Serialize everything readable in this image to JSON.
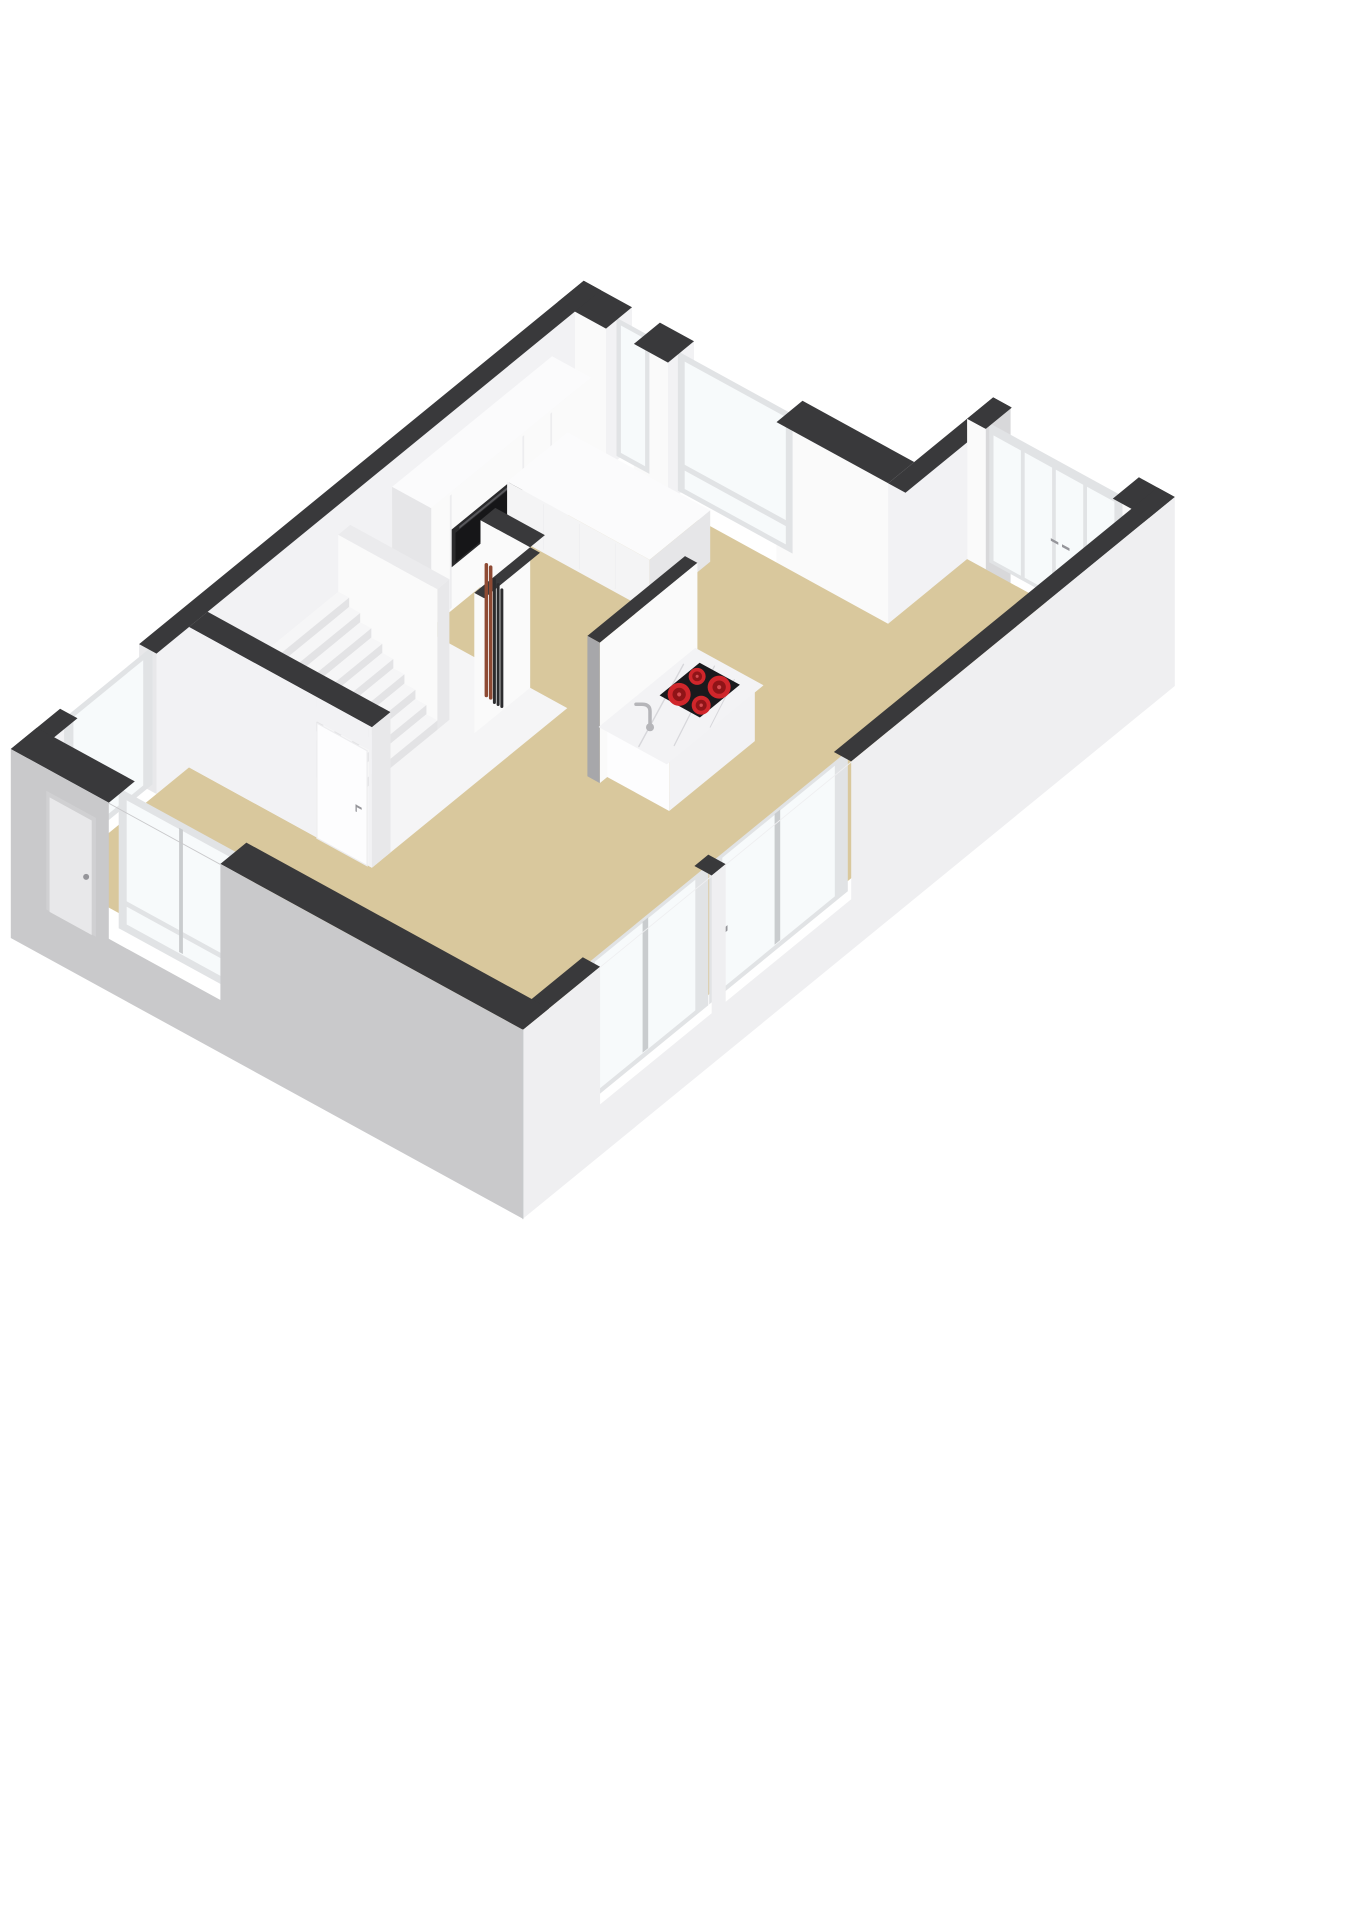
{
  "scene": {
    "type": "3d-floor-plan-render",
    "rooms": [
      "kitchen",
      "living-room",
      "hallway-with-stairs",
      "meter-closet"
    ],
    "features": {
      "stair_steps": 9,
      "hob_burners": 4,
      "french_door_panels": 4,
      "se_windows": 2,
      "ne_windows": 2,
      "sw_windows": 1,
      "nw_windows": 1,
      "meter_pipes_copper": 2,
      "meter_pipes_dark": 3,
      "ovens": 1,
      "interior_doors": 1,
      "front_doors": 1
    }
  },
  "colors": {
    "background": "#ffffff",
    "wall_cap": "#39393b",
    "cap_light": "#ebebed",
    "wall_white": "#fafafa",
    "wall_soft": "#f2f2f4",
    "wall_shade": "#e8e8ea",
    "wall_dark_face": "#a7a7aa",
    "ext_left": "#c9c9cb",
    "ext_right": "#efeff1",
    "ext_notch": "#d8d8da",
    "floor_main": "#d9c89d",
    "floor_hall": "#f5f5f6",
    "stair_top": "#f6f6f7",
    "stair_riser": "#e3e3e5",
    "stair_side": "#efeff0",
    "counter_top": "#fbfbfc",
    "counter_front": "#f4f4f5",
    "cabinet_shade": "#e6e6e8",
    "seam": "#ededef",
    "oven_frame": "#2a2a2c",
    "oven_door": "#161618",
    "oven_handle": "#58585c",
    "marble": "#f3f3f5",
    "marble_vein": "#d7d7db",
    "cooktop": "#1a1a1d",
    "burner": "#d0262b",
    "burner_core": "#8f1417",
    "burner_dot": "#d4494e",
    "glass": "#f7fafb",
    "frame": "#e1e3e5",
    "frame_shade": "#c9ccce",
    "pipe_copper": "#8e4a33",
    "pipe_dark": "#2c2c2e",
    "handle": "#95959a",
    "door_leaf": "#fdfdfe",
    "front_door": "#e8e8ea",
    "front_door_frame": "#d0d0d2",
    "faucet": "#b5b5b9"
  }
}
